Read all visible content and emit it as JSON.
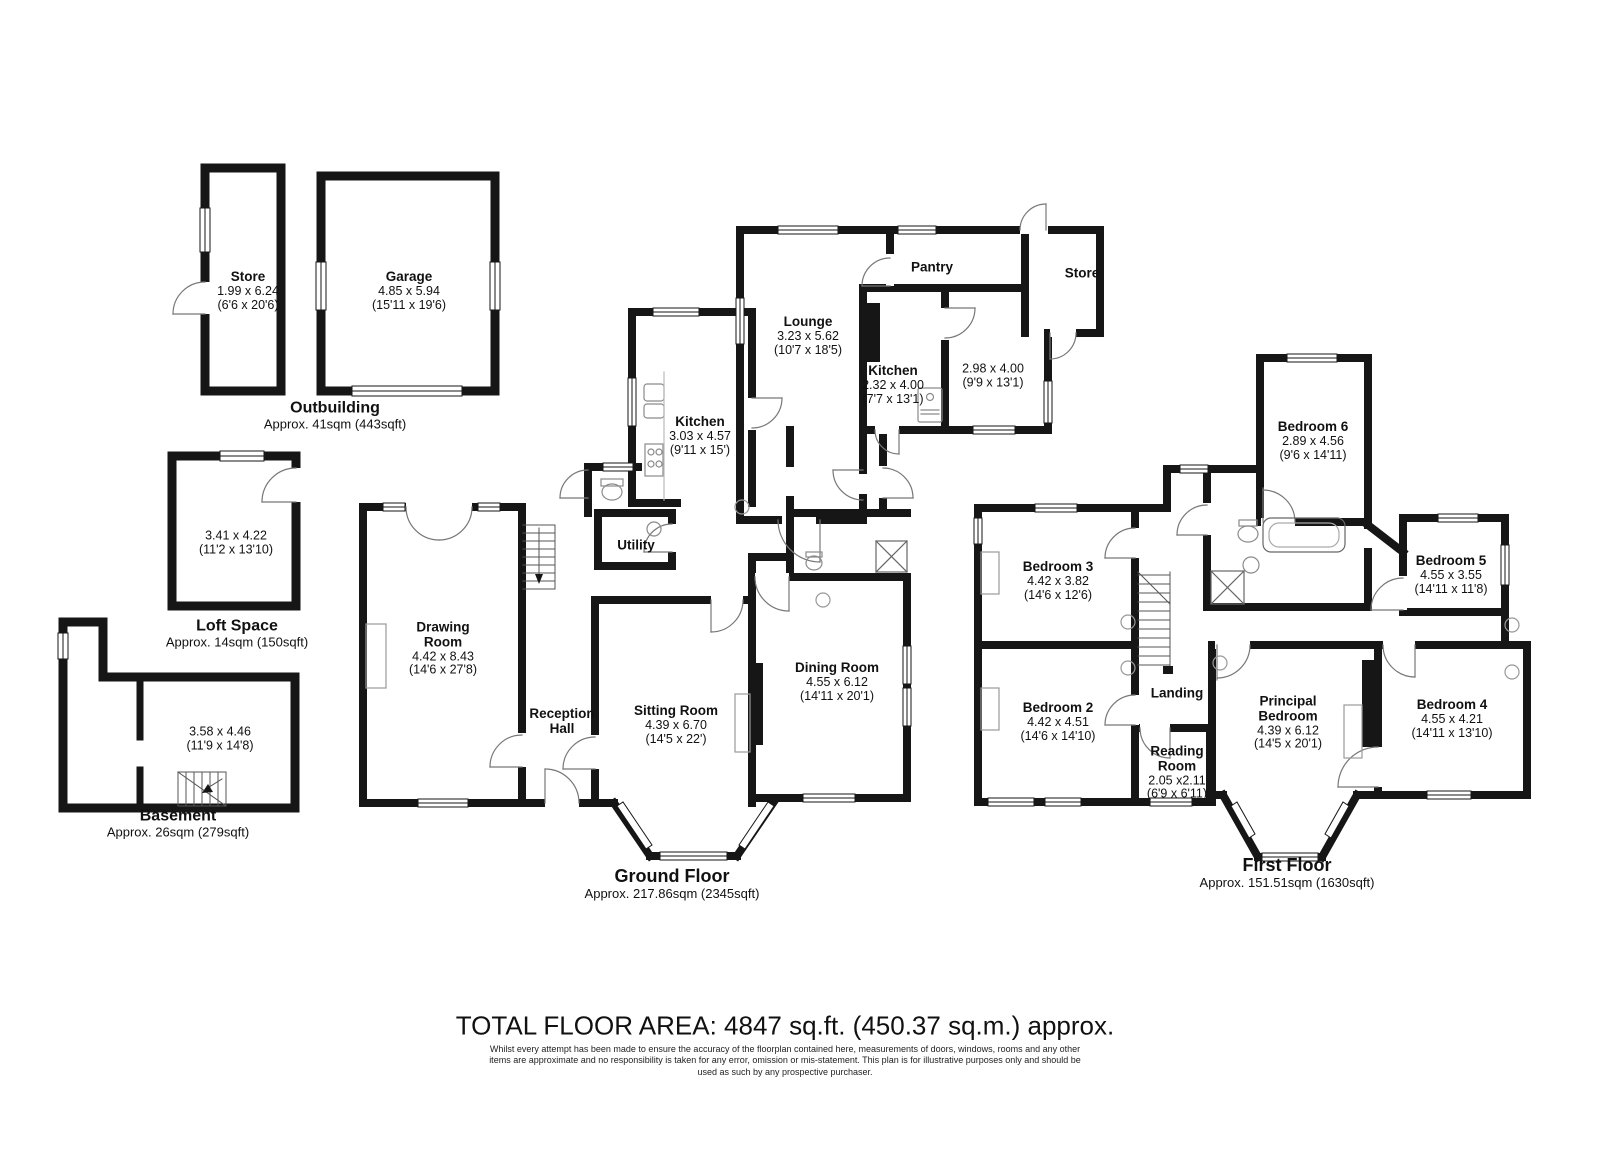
{
  "outbuilding": {
    "title": "Outbuilding",
    "area": "Approx. 41sqm (443sqft)",
    "rooms": {
      "store": {
        "name": "Store",
        "metric": "1.99 x 6.24",
        "imperial": "(6'6 x 20'6)"
      },
      "garage": {
        "name": "Garage",
        "metric": "4.85 x 5.94",
        "imperial": "(15'11 x 19'6)"
      }
    }
  },
  "loft": {
    "title": "Loft Space",
    "area": "Approx. 14sqm (150sqft)",
    "rooms": {
      "loft_room": {
        "metric": "3.41 x 4.22",
        "imperial": "(11'2 x 13'10)"
      }
    }
  },
  "basement": {
    "title": "Basement",
    "area": "Approx. 26sqm (279sqft)",
    "rooms": {
      "basement_room": {
        "metric": "3.58 x 4.46",
        "imperial": "(11'9 x 14'8)"
      }
    }
  },
  "ground_floor": {
    "title": "Ground Floor",
    "area": "Approx. 217.86sqm (2345sqft)",
    "rooms": {
      "lounge": {
        "name": "Lounge",
        "metric": "3.23 x 5.62",
        "imperial": "(10'7 x 18'5)"
      },
      "pantry": {
        "name": "Pantry"
      },
      "store": {
        "name": "Store"
      },
      "kitchen_rear": {
        "name": "Kitchen",
        "metric": "2.32 x 4.00",
        "imperial": "(7'7 x 13'1)"
      },
      "rear_room": {
        "metric": "2.98 x 4.00",
        "imperial": "(9'9 x 13'1)"
      },
      "kitchen": {
        "name": "Kitchen",
        "metric": "3.03 x 4.57",
        "imperial": "(9'11 x 15')"
      },
      "utility": {
        "name": "Utility"
      },
      "drawing_room": {
        "name": "Drawing Room",
        "metric": "4.42 x 8.43",
        "imperial": "(14'6 x 27'8)"
      },
      "reception_hall": {
        "name": "Reception Hall"
      },
      "sitting_room": {
        "name": "Sitting Room",
        "metric": "4.39 x 6.70",
        "imperial": "(14'5 x 22')"
      },
      "dining_room": {
        "name": "Dining Room",
        "metric": "4.55 x 6.12",
        "imperial": "(14'11 x 20'1)"
      }
    }
  },
  "first_floor": {
    "title": "First Floor",
    "area": "Approx. 151.51sqm (1630sqft)",
    "rooms": {
      "bedroom6": {
        "name": "Bedroom 6",
        "metric": "2.89 x 4.56",
        "imperial": "(9'6 x 14'11)"
      },
      "bedroom3": {
        "name": "Bedroom 3",
        "metric": "4.42 x 3.82",
        "imperial": "(14'6 x 12'6)"
      },
      "bedroom5": {
        "name": "Bedroom 5",
        "metric": "4.55 x 3.55",
        "imperial": "(14'11 x 11'8)"
      },
      "bedroom2": {
        "name": "Bedroom 2",
        "metric": "4.42 x 4.51",
        "imperial": "(14'6 x 14'10)"
      },
      "landing": {
        "name": "Landing"
      },
      "reading_room": {
        "name": "Reading Room",
        "metric": "2.05 x2.11",
        "imperial": "(6'9 x 6'11)"
      },
      "principal_bedroom": {
        "name": "Principal Bedroom",
        "metric": "4.39 x 6.12",
        "imperial": "(14'5 x 20'1)"
      },
      "bedroom4": {
        "name": "Bedroom 4",
        "metric": "4.55 x 4.21",
        "imperial": "(14'11 x 13'10)"
      }
    }
  },
  "footer": {
    "total": "TOTAL FLOOR AREA: 4847 sq.ft. (450.37 sq.m.) approx.",
    "disclaimer": "Whilst every attempt has been made to ensure the accuracy of the floorplan contained here, measurements of doors, windows, rooms and any other items are approximate and no responsibility is taken for any error, omission or mis-statement. This plan is for illustrative purposes only and should be used as such by any prospective purchaser."
  }
}
